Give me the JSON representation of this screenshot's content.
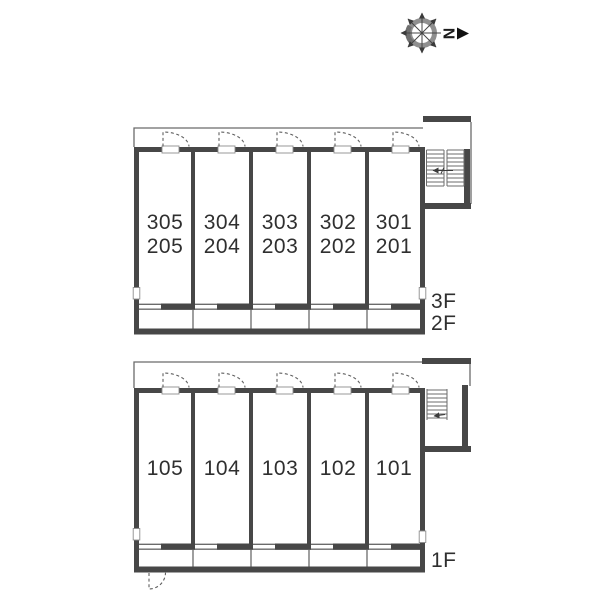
{
  "compass": {
    "north_label": "N"
  },
  "upper_plan": {
    "floor_labels": [
      "3F",
      "2F"
    ],
    "units": [
      {
        "line1": "305",
        "line2": "205"
      },
      {
        "line1": "304",
        "line2": "204"
      },
      {
        "line1": "303",
        "line2": "203"
      },
      {
        "line1": "302",
        "line2": "202"
      },
      {
        "line1": "301",
        "line2": "201"
      }
    ]
  },
  "lower_plan": {
    "floor_label": "1F",
    "units": [
      {
        "label": "105"
      },
      {
        "label": "104"
      },
      {
        "label": "103"
      },
      {
        "label": "102"
      },
      {
        "label": "101"
      }
    ]
  },
  "colors": {
    "wall": "#474747",
    "line": "#6b6b6b",
    "text": "#2f2f2f"
  }
}
